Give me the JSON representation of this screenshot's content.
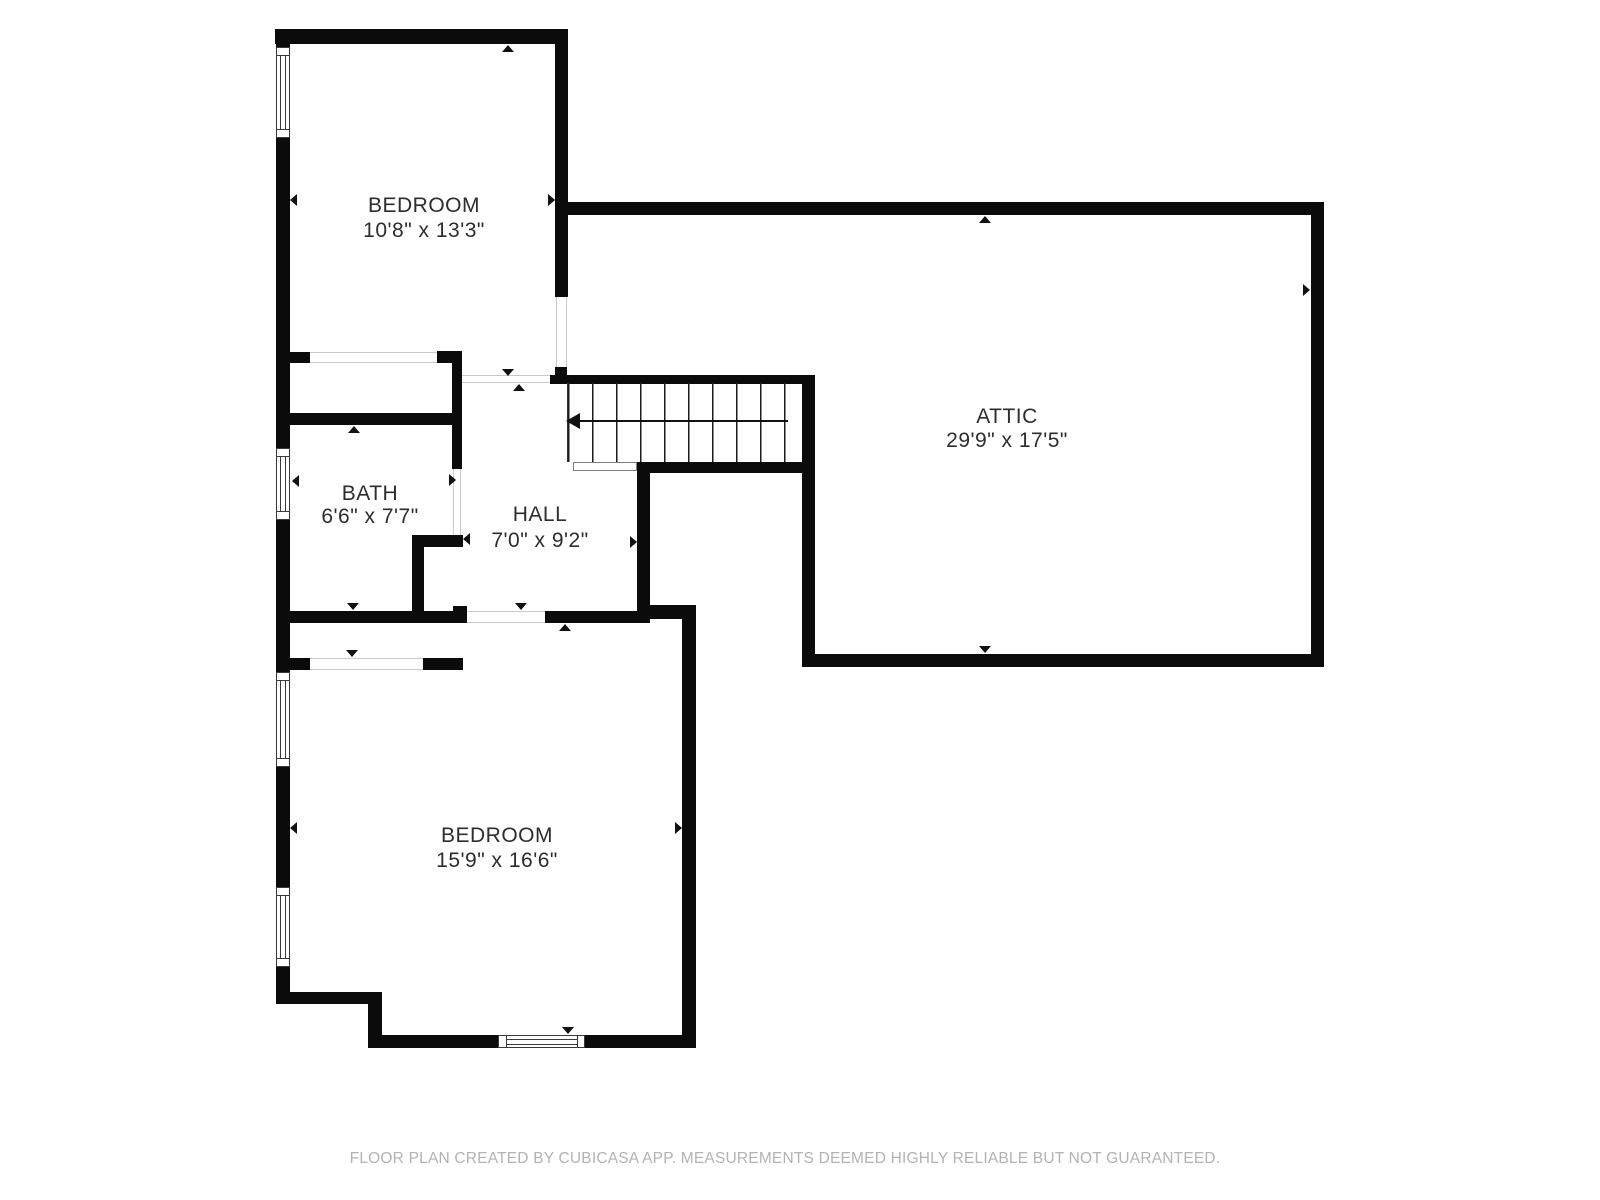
{
  "page": {
    "background": "#ffffff",
    "width": 1600,
    "height": 1200
  },
  "colors": {
    "wall": "#0b0b0b",
    "label_text": "#2d2d2d",
    "footer_text": "#b3b3b3",
    "opening_line": "#c9c9c9",
    "window_frame": "#3a3a3a"
  },
  "footer": {
    "text": "FLOOR PLAN CREATED BY CUBICASA APP. MEASUREMENTS DEEMED HIGHLY RELIABLE BUT NOT GUARANTEED.",
    "cx": 785,
    "cy": 1159
  },
  "rooms": [
    {
      "id": "bedroom-1",
      "name": "BEDROOM",
      "dims": "10'8\" x 13'3\"",
      "cx": 424,
      "cy": 206,
      "cy2": 231
    },
    {
      "id": "attic",
      "name": "ATTIC",
      "dims": "29'9\" x 17'5\"",
      "cx": 1007,
      "cy": 417,
      "cy2": 441
    },
    {
      "id": "bath",
      "name": "BATH",
      "dims": "6'6\" x 7'7\"",
      "cx": 370,
      "cy": 494,
      "cy2": 517
    },
    {
      "id": "hall",
      "name": "HALL",
      "dims": "7'0\" x 9'2\"",
      "cx": 540,
      "cy": 515,
      "cy2": 541
    },
    {
      "id": "bedroom-2",
      "name": "BEDROOM",
      "dims": "15'9\" x 16'6\"",
      "cx": 497,
      "cy": 836,
      "cy2": 861
    }
  ],
  "geometry": {
    "walls": [
      [
        275,
        29,
        293,
        15
      ],
      [
        276,
        29,
        14,
        19
      ],
      [
        276,
        138,
        14,
        310
      ],
      [
        276,
        520,
        14,
        152
      ],
      [
        276,
        767,
        14,
        120
      ],
      [
        276,
        967,
        14,
        37
      ],
      [
        555,
        29,
        13,
        268
      ],
      [
        290,
        352,
        20,
        11
      ],
      [
        437,
        351,
        25,
        12
      ],
      [
        452,
        351,
        10,
        118
      ],
      [
        276,
        413,
        179,
        12
      ],
      [
        412,
        535,
        51,
        12
      ],
      [
        412,
        547,
        12,
        65
      ],
      [
        276,
        611,
        191,
        12
      ],
      [
        453,
        606,
        14,
        17
      ],
      [
        545,
        611,
        105,
        12
      ],
      [
        637,
        462,
        13,
        150
      ],
      [
        650,
        605,
        46,
        14
      ],
      [
        682,
        605,
        14,
        443
      ],
      [
        368,
        1035,
        130,
        13
      ],
      [
        585,
        1035,
        111,
        13
      ],
      [
        276,
        992,
        106,
        12
      ],
      [
        368,
        992,
        14,
        55
      ],
      [
        290,
        658,
        20,
        12
      ],
      [
        423,
        658,
        40,
        12
      ],
      [
        555,
        367,
        12,
        16
      ],
      [
        550,
        375,
        265,
        9
      ],
      [
        637,
        462,
        178,
        11
      ],
      [
        802,
        375,
        13,
        292
      ],
      [
        568,
        202,
        756,
        13
      ],
      [
        1311,
        202,
        13,
        465
      ],
      [
        802,
        654,
        522,
        13
      ]
    ],
    "windows": [
      {
        "x": 276,
        "y": 47,
        "w": 14,
        "h": 91,
        "orient": "v"
      },
      {
        "x": 276,
        "y": 448,
        "w": 14,
        "h": 72,
        "orient": "v"
      },
      {
        "x": 276,
        "y": 672,
        "w": 14,
        "h": 95,
        "orient": "v"
      },
      {
        "x": 276,
        "y": 887,
        "w": 14,
        "h": 80,
        "orient": "v"
      },
      {
        "x": 498,
        "y": 1035,
        "w": 87,
        "h": 13,
        "orient": "h"
      }
    ],
    "openings": [
      {
        "x": 310,
        "y": 352,
        "w": 127,
        "h": 11,
        "orient": "h"
      },
      {
        "x": 556,
        "y": 297,
        "w": 11,
        "h": 78,
        "orient": "v"
      },
      {
        "x": 462,
        "y": 375,
        "w": 93,
        "h": 8,
        "orient": "h"
      },
      {
        "x": 453,
        "y": 469,
        "w": 8,
        "h": 66,
        "orient": "v"
      },
      {
        "x": 310,
        "y": 658,
        "w": 113,
        "h": 12,
        "orient": "h"
      },
      {
        "x": 467,
        "y": 611,
        "w": 78,
        "h": 12,
        "orient": "h"
      }
    ],
    "arrows": [
      {
        "x": 508,
        "y": 45,
        "dir": "up"
      },
      {
        "x": 290,
        "y": 200,
        "dir": "left"
      },
      {
        "x": 555,
        "y": 200,
        "dir": "right"
      },
      {
        "x": 985,
        "y": 216,
        "dir": "up"
      },
      {
        "x": 1310,
        "y": 290,
        "dir": "right"
      },
      {
        "x": 985,
        "y": 653,
        "dir": "down"
      },
      {
        "x": 354,
        "y": 426,
        "dir": "up"
      },
      {
        "x": 353,
        "y": 610,
        "dir": "down"
      },
      {
        "x": 292,
        "y": 481,
        "dir": "left"
      },
      {
        "x": 456,
        "y": 480,
        "dir": "right"
      },
      {
        "x": 463,
        "y": 539,
        "dir": "left"
      },
      {
        "x": 508,
        "y": 376,
        "dir": "down"
      },
      {
        "x": 519,
        "y": 384,
        "dir": "up"
      },
      {
        "x": 637,
        "y": 542,
        "dir": "right"
      },
      {
        "x": 521,
        "y": 610,
        "dir": "down"
      },
      {
        "x": 565,
        "y": 624,
        "dir": "up"
      },
      {
        "x": 290,
        "y": 828,
        "dir": "left"
      },
      {
        "x": 682,
        "y": 828,
        "dir": "right"
      },
      {
        "x": 568,
        "y": 1034,
        "dir": "down"
      },
      {
        "x": 352,
        "y": 657,
        "dir": "down"
      }
    ],
    "stairs": {
      "treads": {
        "x": 567,
        "y": 383,
        "w": 240,
        "h": 79
      },
      "run_line": {
        "x": 580,
        "y": 420,
        "w": 208,
        "h": 2
      },
      "arrowhead": {
        "x": 566,
        "y": 421
      },
      "landing": {
        "x": 573,
        "y": 462,
        "w": 64,
        "h": 9
      }
    }
  }
}
